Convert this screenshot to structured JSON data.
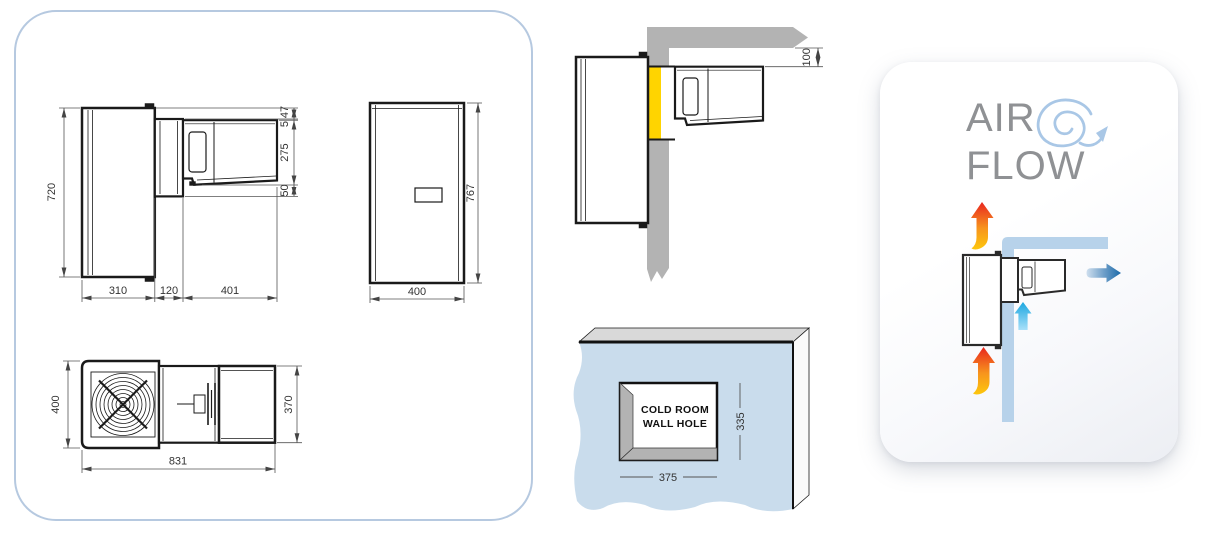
{
  "drawings_panel": {
    "side_view": {
      "height": "720",
      "width_left": "310",
      "width_middle": "120",
      "width_right": "401",
      "top_offset": "47",
      "gap": "5",
      "condenser_height": "275",
      "bottom_offset": "50"
    },
    "front_view": {
      "width": "400",
      "height": "767"
    },
    "top_view": {
      "depth_left": "400",
      "depth_right": "370",
      "length": "831"
    }
  },
  "installation_view": {
    "ceiling_clearance": "100"
  },
  "wall_hole_view": {
    "label_line1": "COLD ROOM",
    "label_line2": "WALL HOLE",
    "hole_width": "375",
    "hole_height": "335"
  },
  "air_flow_panel": {
    "title_line1": "AIR",
    "title_line2": "FLOW"
  },
  "colors": {
    "panel_border": "#b6c9e0",
    "line_art": "#1a1a1a",
    "dimension_lines": "#555555",
    "wall_gray": "#b3b3b3",
    "gasket_yellow": "#ffd400",
    "coldroom_wall_blue": "#c9dcec",
    "bevel_gray": "#b3b3b3",
    "airflow_wall_blue": "#b7d2ea",
    "swirl_blue": "#a9c7e6",
    "title_gray": "#8f9194",
    "warm_air_yellow": "#fdc70c",
    "warm_air_red": "#e8251f",
    "cold_air_blue": "#29abe2",
    "exhaust_air_blue": "#1b6aa9"
  }
}
